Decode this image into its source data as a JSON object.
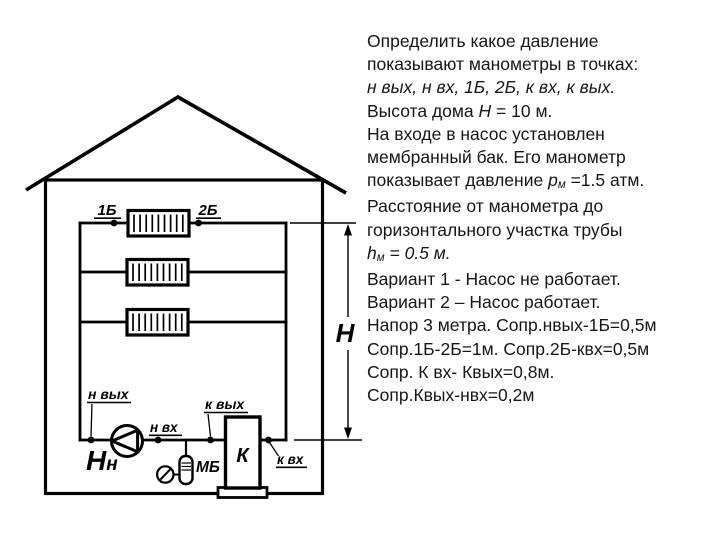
{
  "colors": {
    "background": "#ffffff",
    "line": "#000000",
    "text": "#161616"
  },
  "problem": {
    "line1": "Определить какое давление",
    "line2": "показывают манометры в точках:",
    "line3": "н вых, н вх, 1Б, 2Б, к вх, к вых.",
    "line4a": "Высота дома ",
    "line4b": "Н",
    "line4c": " = 10 м.",
    "line5": "На входе в насос установлен",
    "line6": "мембранный бак. Его манометр",
    "line7a": "показывает давление ",
    "line7b": "р",
    "line7c": "м",
    "line7d": " =1.5 атм.",
    "line8": "Расстояние от манометра до",
    "line9": "горизонтального участка трубы",
    "line10a": "h",
    "line10b": "м",
    "line10c": " = 0.5 м.",
    "line11": "Вариант 1 - Насос не работает.",
    "line12": "Вариант 2 – Насос работает.",
    "line13": "Напор 3 метра. Сопр.нвых-1Б=0,5м",
    "line14": "Сопр.1Б-2Б=1м. Сопр.2Б-квх=0,5м",
    "line15": "Сопр. К вх- Квых=0,8м.",
    "line16": "Сопр.Квых-нвх=0,2м"
  },
  "diagram": {
    "radiator1_left": "1Б",
    "radiator1_right": "2Б",
    "pump_outlet": "н вых",
    "pump_inlet": "н вх",
    "boiler_outlet": "к вых",
    "boiler_inlet": "к вх",
    "boiler": "К",
    "membrane_tank": "МБ",
    "pump_head_main": "Н",
    "pump_head_sub": "н",
    "house_height": "Н"
  }
}
